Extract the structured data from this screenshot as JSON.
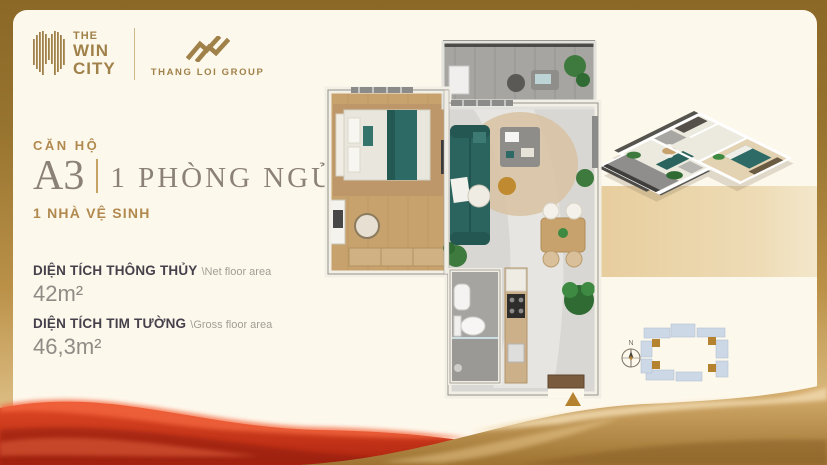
{
  "brand": {
    "win_city": {
      "line1": "THE",
      "line2": "WIN",
      "line3": "CITY"
    },
    "thang_loi": "THANG LOI GROUP"
  },
  "unit": {
    "category": "CĂN HỘ",
    "code": "A3",
    "bedrooms": "1 PHÒNG NGỦ",
    "bathrooms": "1 NHÀ VỆ SINH"
  },
  "areas": {
    "net": {
      "label": "DIỆN TÍCH THÔNG THỦY",
      "sublabel": "\\Net floor area",
      "value": "42m²"
    },
    "gross": {
      "label": "DIỆN TÍCH TIM TƯỜNG",
      "sublabel": "\\Gross floor area",
      "value": "46,3m²"
    }
  },
  "site_plan": {
    "compass": "N"
  },
  "icons": {
    "win_city_logo_icon": "vertical-bars-building",
    "thang_loi_logo_icon": "double-mountain-zigzag",
    "entrance_marker": "gold-triangle-up",
    "compass_icon": "compass-north"
  },
  "colors": {
    "gold_accent": "#b1894e",
    "frame_gold": "#96732e",
    "cream_bg": "#fdf8ec",
    "title_taupe": "#8b8177",
    "label_dark": "#45414b",
    "value_gray": "#8f8c86",
    "ribbon_red": "#c22f14",
    "ribbon_gold": "#c59d5d",
    "teal_furniture": "#2d6a65",
    "tan_highlight": "#ead2a4",
    "site_block_blue": "#cdd8e6"
  }
}
